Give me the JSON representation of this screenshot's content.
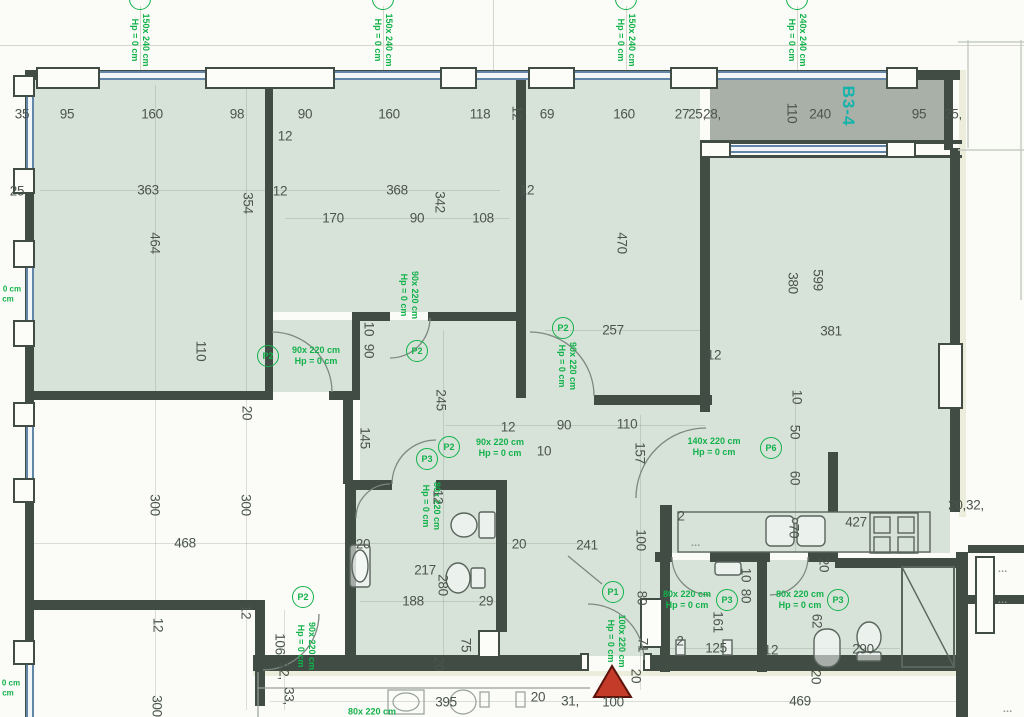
{
  "meta": {
    "unit_label": "B3-4"
  },
  "colors": {
    "room_fill": "#d7e2d9",
    "terrace_fill": "#a8b0a7",
    "wall": "#414c45",
    "annotation_green": "#12b24a",
    "unit_label_teal": "#14b3ab",
    "dimension_text": "#4b554e",
    "entrance_marker_red": "#c43b2a",
    "window_glazing_blue": "#6285aa"
  },
  "annotations": {
    "window_labels": [
      {
        "line1": "150x 240 cm",
        "line2": "Hp = 0 cm",
        "x": 140,
        "y": 40
      },
      {
        "line1": "150x 240 cm",
        "line2": "Hp = 0 cm",
        "x": 383,
        "y": 40
      },
      {
        "line1": "150x 240 cm",
        "line2": "Hp = 0 cm",
        "x": 626,
        "y": 40
      },
      {
        "line1": "240x 240 cm",
        "line2": "Hp = 0 cm",
        "x": 797,
        "y": 40
      }
    ],
    "edge_labels": [
      {
        "text": "0 cm",
        "x": 12,
        "y": 289
      },
      {
        "text": "cm",
        "x": 8,
        "y": 299
      },
      {
        "text": "0 cm",
        "x": 11,
        "y": 683
      },
      {
        "text": "cm",
        "x": 8,
        "y": 693
      }
    ],
    "door_labels": [
      {
        "code": "P2",
        "size": "90x 220 cm",
        "hp": "Hp = 0 cm",
        "cx": 268,
        "cy": 356,
        "tx": 316,
        "ty": 356,
        "orient": "h"
      },
      {
        "code": "P2",
        "size": "90x 220 cm",
        "hp": "Hp = 0 cm",
        "cx": 417,
        "cy": 351,
        "tx": 409,
        "ty": 295,
        "orient": "v"
      },
      {
        "code": "P2",
        "size": "90x 220 cm",
        "hp": "Hp = 0 cm",
        "cx": 563,
        "cy": 328,
        "tx": 567,
        "ty": 366,
        "orient": "v"
      },
      {
        "code": "P2",
        "size": "90x 220 cm",
        "hp": "Hp = 0 cm",
        "cx": 449,
        "cy": 447,
        "tx": 500,
        "ty": 448,
        "orient": "h"
      },
      {
        "code": "P3",
        "size": "80x 220 cm",
        "hp": "Hp = 0 cm",
        "cx": 427,
        "cy": 459,
        "tx": 431,
        "ty": 506,
        "orient": "v"
      },
      {
        "code": "P6",
        "size": "140x 220 cm",
        "hp": "Hp = 0 cm",
        "cx": 771,
        "cy": 448,
        "tx": 714,
        "ty": 447,
        "orient": "h"
      },
      {
        "code": "P1",
        "size": "100x 220 cm",
        "hp": "Hp = 0 cm",
        "cx": 613,
        "cy": 592,
        "tx": 616,
        "ty": 641,
        "orient": "v"
      },
      {
        "code": "P3",
        "size": "80x 220 cm",
        "hp": "Hp = 0 cm",
        "cx": 727,
        "cy": 600,
        "tx": 687,
        "ty": 600,
        "orient": "h"
      },
      {
        "code": "P3",
        "size": "80x 220 cm",
        "hp": "Hp = 0 cm",
        "cx": 838,
        "cy": 600,
        "tx": 800,
        "ty": 600,
        "orient": "h"
      },
      {
        "code": "P2",
        "size": "90x 220 cm",
        "hp": "Hp = 0 cm",
        "cx": 303,
        "cy": 597,
        "tx": 306,
        "ty": 646,
        "orient": "v"
      },
      {
        "code": "",
        "size": "80x 220 cm",
        "hp": "",
        "cx": null,
        "cy": null,
        "tx": 372,
        "ty": 712,
        "orient": "h"
      }
    ],
    "dimensions": [
      {
        "t": "35",
        "x": 22,
        "y": 114
      },
      {
        "t": "95",
        "x": 67,
        "y": 114
      },
      {
        "t": "160",
        "x": 152,
        "y": 114
      },
      {
        "t": "98",
        "x": 237,
        "y": 114
      },
      {
        "t": "90",
        "x": 305,
        "y": 114
      },
      {
        "t": "160",
        "x": 389,
        "y": 114
      },
      {
        "t": "118",
        "x": 480,
        "y": 114
      },
      {
        "t": "12",
        "x": 517,
        "y": 113,
        "r": 90
      },
      {
        "t": "69",
        "x": 547,
        "y": 114
      },
      {
        "t": "160",
        "x": 624,
        "y": 114
      },
      {
        "t": "27",
        "x": 682,
        "y": 114
      },
      {
        "t": "25,",
        "x": 697,
        "y": 114
      },
      {
        "t": "28,",
        "x": 712,
        "y": 114
      },
      {
        "t": "110",
        "x": 792,
        "y": 113,
        "r": 90
      },
      {
        "t": "240",
        "x": 820,
        "y": 114
      },
      {
        "t": "95",
        "x": 919,
        "y": 114
      },
      {
        "t": "25,",
        "x": 953,
        "y": 114
      },
      {
        "t": "25",
        "x": 17,
        "y": 191
      },
      {
        "t": "363",
        "x": 148,
        "y": 190
      },
      {
        "t": "464",
        "x": 155,
        "y": 243,
        "r": 90
      },
      {
        "t": "354",
        "x": 248,
        "y": 203,
        "r": 90
      },
      {
        "t": "12",
        "x": 285,
        "y": 136
      },
      {
        "t": "12",
        "x": 280,
        "y": 191
      },
      {
        "t": "368",
        "x": 397,
        "y": 190
      },
      {
        "t": "342",
        "x": 440,
        "y": 202,
        "r": 90
      },
      {
        "t": "170",
        "x": 333,
        "y": 218
      },
      {
        "t": "90",
        "x": 417,
        "y": 218
      },
      {
        "t": "108",
        "x": 483,
        "y": 218
      },
      {
        "t": "12",
        "x": 527,
        "y": 190
      },
      {
        "t": "470",
        "x": 622,
        "y": 243,
        "r": 90
      },
      {
        "t": "257",
        "x": 613,
        "y": 330
      },
      {
        "t": "12",
        "x": 714,
        "y": 355
      },
      {
        "t": "599",
        "x": 818,
        "y": 280,
        "r": 90
      },
      {
        "t": "380",
        "x": 793,
        "y": 283,
        "r": 90
      },
      {
        "t": "381",
        "x": 831,
        "y": 331
      },
      {
        "t": "110",
        "x": 201,
        "y": 351,
        "r": 90
      },
      {
        "t": "10",
        "x": 369,
        "y": 329,
        "r": 90
      },
      {
        "t": "90",
        "x": 369,
        "y": 351,
        "r": 90
      },
      {
        "t": "245",
        "x": 441,
        "y": 400,
        "r": 90
      },
      {
        "t": "145",
        "x": 365,
        "y": 438,
        "r": 90
      },
      {
        "t": "20",
        "x": 247,
        "y": 413,
        "r": 90
      },
      {
        "t": "12",
        "x": 508,
        "y": 427
      },
      {
        "t": "90",
        "x": 564,
        "y": 425
      },
      {
        "t": "110",
        "x": 627,
        "y": 424
      },
      {
        "t": "10",
        "x": 544,
        "y": 451
      },
      {
        "t": "157",
        "x": 640,
        "y": 453,
        "r": 90
      },
      {
        "t": "10",
        "x": 797,
        "y": 397,
        "r": 90
      },
      {
        "t": "50",
        "x": 795,
        "y": 432,
        "r": 90
      },
      {
        "t": "60",
        "x": 795,
        "y": 478,
        "r": 90
      },
      {
        "t": "2",
        "x": 681,
        "y": 516
      },
      {
        "t": "70",
        "x": 794,
        "y": 531,
        "r": 90
      },
      {
        "t": "427",
        "x": 856,
        "y": 522
      },
      {
        "t": "20,32,",
        "x": 966,
        "y": 505
      },
      {
        "t": "217",
        "x": 425,
        "y": 570
      },
      {
        "t": "280",
        "x": 443,
        "y": 585,
        "r": 90
      },
      {
        "t": "188",
        "x": 413,
        "y": 601
      },
      {
        "t": "29",
        "x": 486,
        "y": 601
      },
      {
        "t": "20",
        "x": 363,
        "y": 544
      },
      {
        "t": "20",
        "x": 519,
        "y": 544
      },
      {
        "t": "12",
        "x": 438,
        "y": 497,
        "r": 90
      },
      {
        "t": "75",
        "x": 466,
        "y": 645,
        "r": 90
      },
      {
        "t": "20",
        "x": 439,
        "y": 664,
        "r": 90
      },
      {
        "t": "468",
        "x": 185,
        "y": 543
      },
      {
        "t": "300",
        "x": 155,
        "y": 505,
        "r": 90
      },
      {
        "t": "300",
        "x": 246,
        "y": 505,
        "r": 90
      },
      {
        "t": "12",
        "x": 158,
        "y": 625,
        "r": 90
      },
      {
        "t": "12",
        "x": 246,
        "y": 612,
        "r": 90
      },
      {
        "t": "106",
        "x": 280,
        "y": 644,
        "r": 90
      },
      {
        "t": "12,",
        "x": 284,
        "y": 671,
        "r": 90
      },
      {
        "t": "33,",
        "x": 289,
        "y": 696,
        "r": 90
      },
      {
        "t": "300",
        "x": 157,
        "y": 706,
        "r": 90
      },
      {
        "t": "241",
        "x": 587,
        "y": 545
      },
      {
        "t": "100",
        "x": 641,
        "y": 540,
        "r": 90
      },
      {
        "t": "80",
        "x": 642,
        "y": 598,
        "r": 90
      },
      {
        "t": "71",
        "x": 643,
        "y": 645,
        "r": 90
      },
      {
        "t": "20",
        "x": 636,
        "y": 676,
        "r": 90
      },
      {
        "t": "2",
        "x": 680,
        "y": 641
      },
      {
        "t": "10",
        "x": 746,
        "y": 575,
        "r": 90
      },
      {
        "t": "80",
        "x": 746,
        "y": 596,
        "r": 90
      },
      {
        "t": "161",
        "x": 718,
        "y": 622,
        "r": 90
      },
      {
        "t": "125",
        "x": 716,
        "y": 648
      },
      {
        "t": "12",
        "x": 771,
        "y": 650
      },
      {
        "t": "62",
        "x": 817,
        "y": 621,
        "r": 90
      },
      {
        "t": "290",
        "x": 863,
        "y": 649
      },
      {
        "t": "20",
        "x": 824,
        "y": 565,
        "r": 90
      },
      {
        "t": "20",
        "x": 816,
        "y": 677,
        "r": 90
      },
      {
        "t": "395",
        "x": 446,
        "y": 702
      },
      {
        "t": "20",
        "x": 538,
        "y": 697
      },
      {
        "t": "31,",
        "x": 570,
        "y": 701
      },
      {
        "t": "100",
        "x": 613,
        "y": 702
      },
      {
        "t": "469",
        "x": 800,
        "y": 701
      }
    ],
    "marks": [
      {
        "t": "▪▪▪",
        "x": 696,
        "y": 546
      },
      {
        "t": "▪▪▪",
        "x": 1003,
        "y": 572
      },
      {
        "t": "▪▪▪",
        "x": 1003,
        "y": 603
      },
      {
        "t": "▪▪▪",
        "x": 1008,
        "y": 712
      }
    ]
  }
}
